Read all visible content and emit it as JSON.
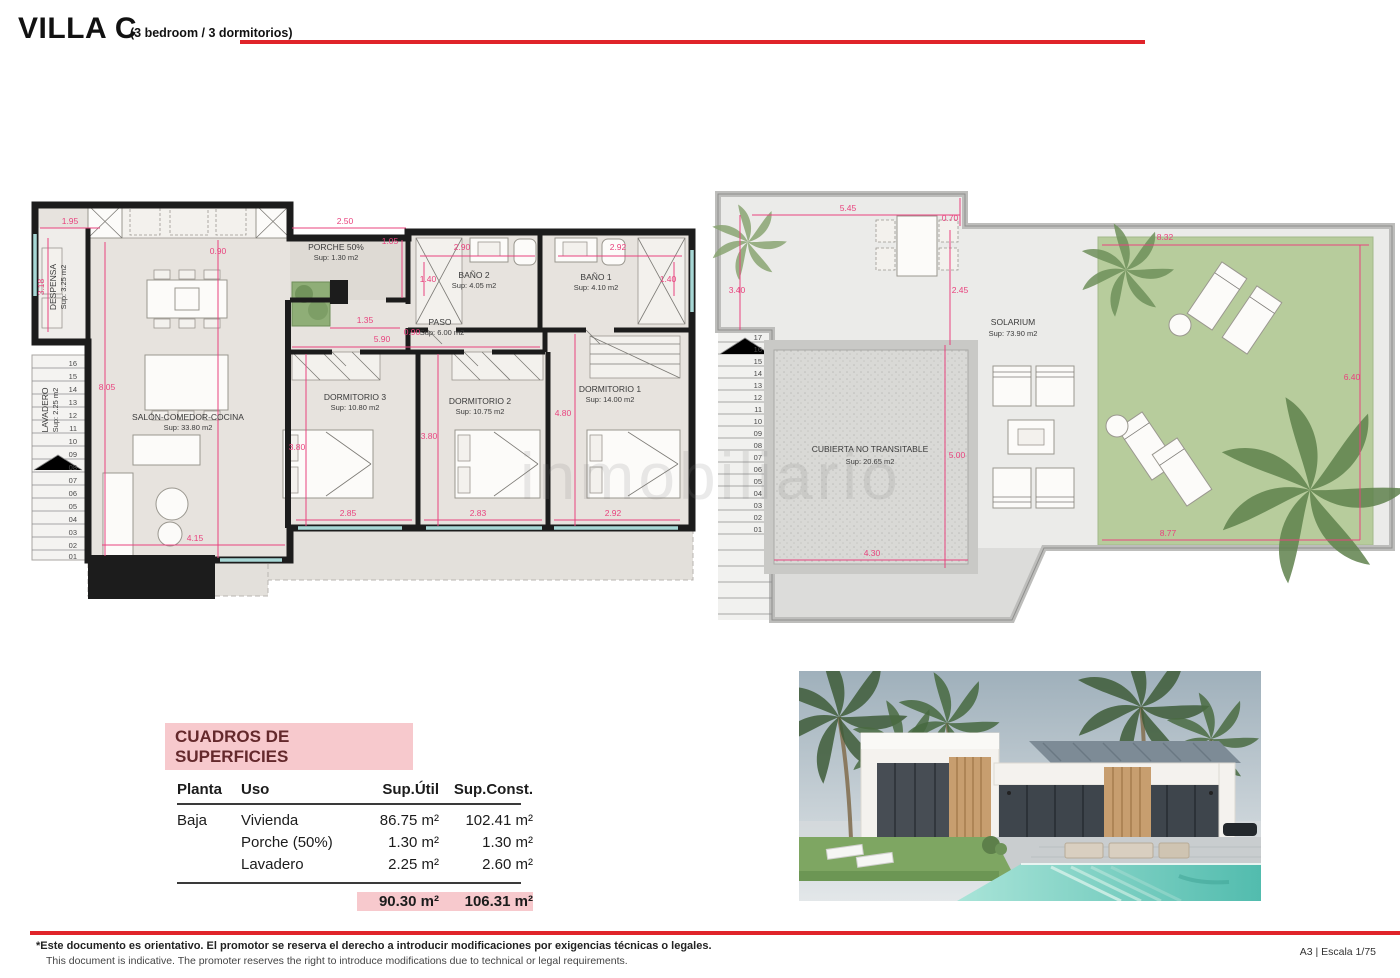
{
  "header": {
    "title": "VILLA C",
    "subtitle": "(3 bedroom / 3 dormitorios)"
  },
  "watermark": "inmobiliario",
  "colors": {
    "accent_red": "#e0242a",
    "dim_pink": "#e8437e",
    "table_pink": "#f7c9cd",
    "lawn_green": "#b7cc9c"
  },
  "ground_plan": {
    "rooms": {
      "despensa": {
        "name": "DESPENSA",
        "area": "Sup: 3.25 m2"
      },
      "lavadero": {
        "name": "LAVADERO",
        "area": "Sup: 2.25 m2"
      },
      "salon": {
        "name": "SALÓN-COMEDOR-COCINA",
        "area": "Sup: 33.80 m2"
      },
      "porche": {
        "name": "PORCHE 50%",
        "area": "Sup: 1.30 m2"
      },
      "paso": {
        "name": "PASO",
        "area": "Sup: 6.00 m2"
      },
      "bano2": {
        "name": "BAÑO 2",
        "area": "Sup: 4.05 m2"
      },
      "bano1": {
        "name": "BAÑO 1",
        "area": "Sup: 4.10 m2"
      },
      "dorm3": {
        "name": "DORMITORIO 3",
        "area": "Sup: 10.80 m2"
      },
      "dorm2": {
        "name": "DORMITORIO 2",
        "area": "Sup: 10.75 m2"
      },
      "dorm1": {
        "name": "DORMITORIO 1",
        "area": "Sup: 14.00 m2"
      }
    },
    "dims": {
      "d195": "1.95",
      "d318": "3.18",
      "d090k": "0.90",
      "d805": "8.05",
      "d250": "2.50",
      "d105": "1.05",
      "d135": "1.35",
      "d090p": "0.90",
      "d590": "5.90",
      "d290": "2.90",
      "d140a": "1.40",
      "d292t": "2.92",
      "d140b": "1.40",
      "d480": "4.80",
      "d380a": "3.80",
      "d380b": "3.80",
      "d285": "2.85",
      "d283": "2.83",
      "d292b": "2.92",
      "d415": "4.15"
    },
    "stairs": [
      "16",
      "15",
      "14",
      "13",
      "12",
      "11",
      "10",
      "09",
      "08",
      "07",
      "06",
      "05",
      "04",
      "03",
      "02",
      "01"
    ]
  },
  "roof_plan": {
    "rooms": {
      "solarium": {
        "name": "SOLARIUM",
        "area": "Sup: 73.90 m2"
      },
      "cubierta": {
        "name": "CUBIERTA NO TRANSITABLE",
        "area": "Sup: 20.65 m2"
      }
    },
    "dims": {
      "d545": "5.45",
      "d070": "0.70",
      "d340": "3.40",
      "d245": "2.45",
      "d832": "8.32",
      "d640": "6.40",
      "d500": "5.00",
      "d430": "4.30",
      "d877": "8.77"
    },
    "stairs": [
      "17",
      "16",
      "15",
      "14",
      "13",
      "12",
      "11",
      "10",
      "09",
      "08",
      "07",
      "06",
      "05",
      "04",
      "03",
      "02",
      "01"
    ]
  },
  "surface_table": {
    "title": "CUADROS DE SUPERFICIES",
    "columns": [
      "Planta",
      "Uso",
      "Sup.Útil",
      "Sup.Const."
    ],
    "rows": [
      {
        "planta": "Baja",
        "uso": "Vivienda",
        "util": "86.75 m²",
        "const": "102.41 m²"
      },
      {
        "planta": "",
        "uso": "Porche (50%)",
        "util": "1.30 m²",
        "const": "1.30 m²"
      },
      {
        "planta": "",
        "uso": "Lavadero",
        "util": "2.25 m²",
        "const": "2.60 m²"
      }
    ],
    "total": {
      "util": "90.30 m²",
      "const": "106.31 m²"
    }
  },
  "footer": {
    "line1": "*Este documento es orientativo. El promotor se reserva el derecho a introducir modificaciones por exigencias técnicas o legales.",
    "line2": "This document is indicative. The promoter reserves the right to introduce modifications due to technical or legal requirements.",
    "scale": "A3 | Escala 1/75"
  }
}
